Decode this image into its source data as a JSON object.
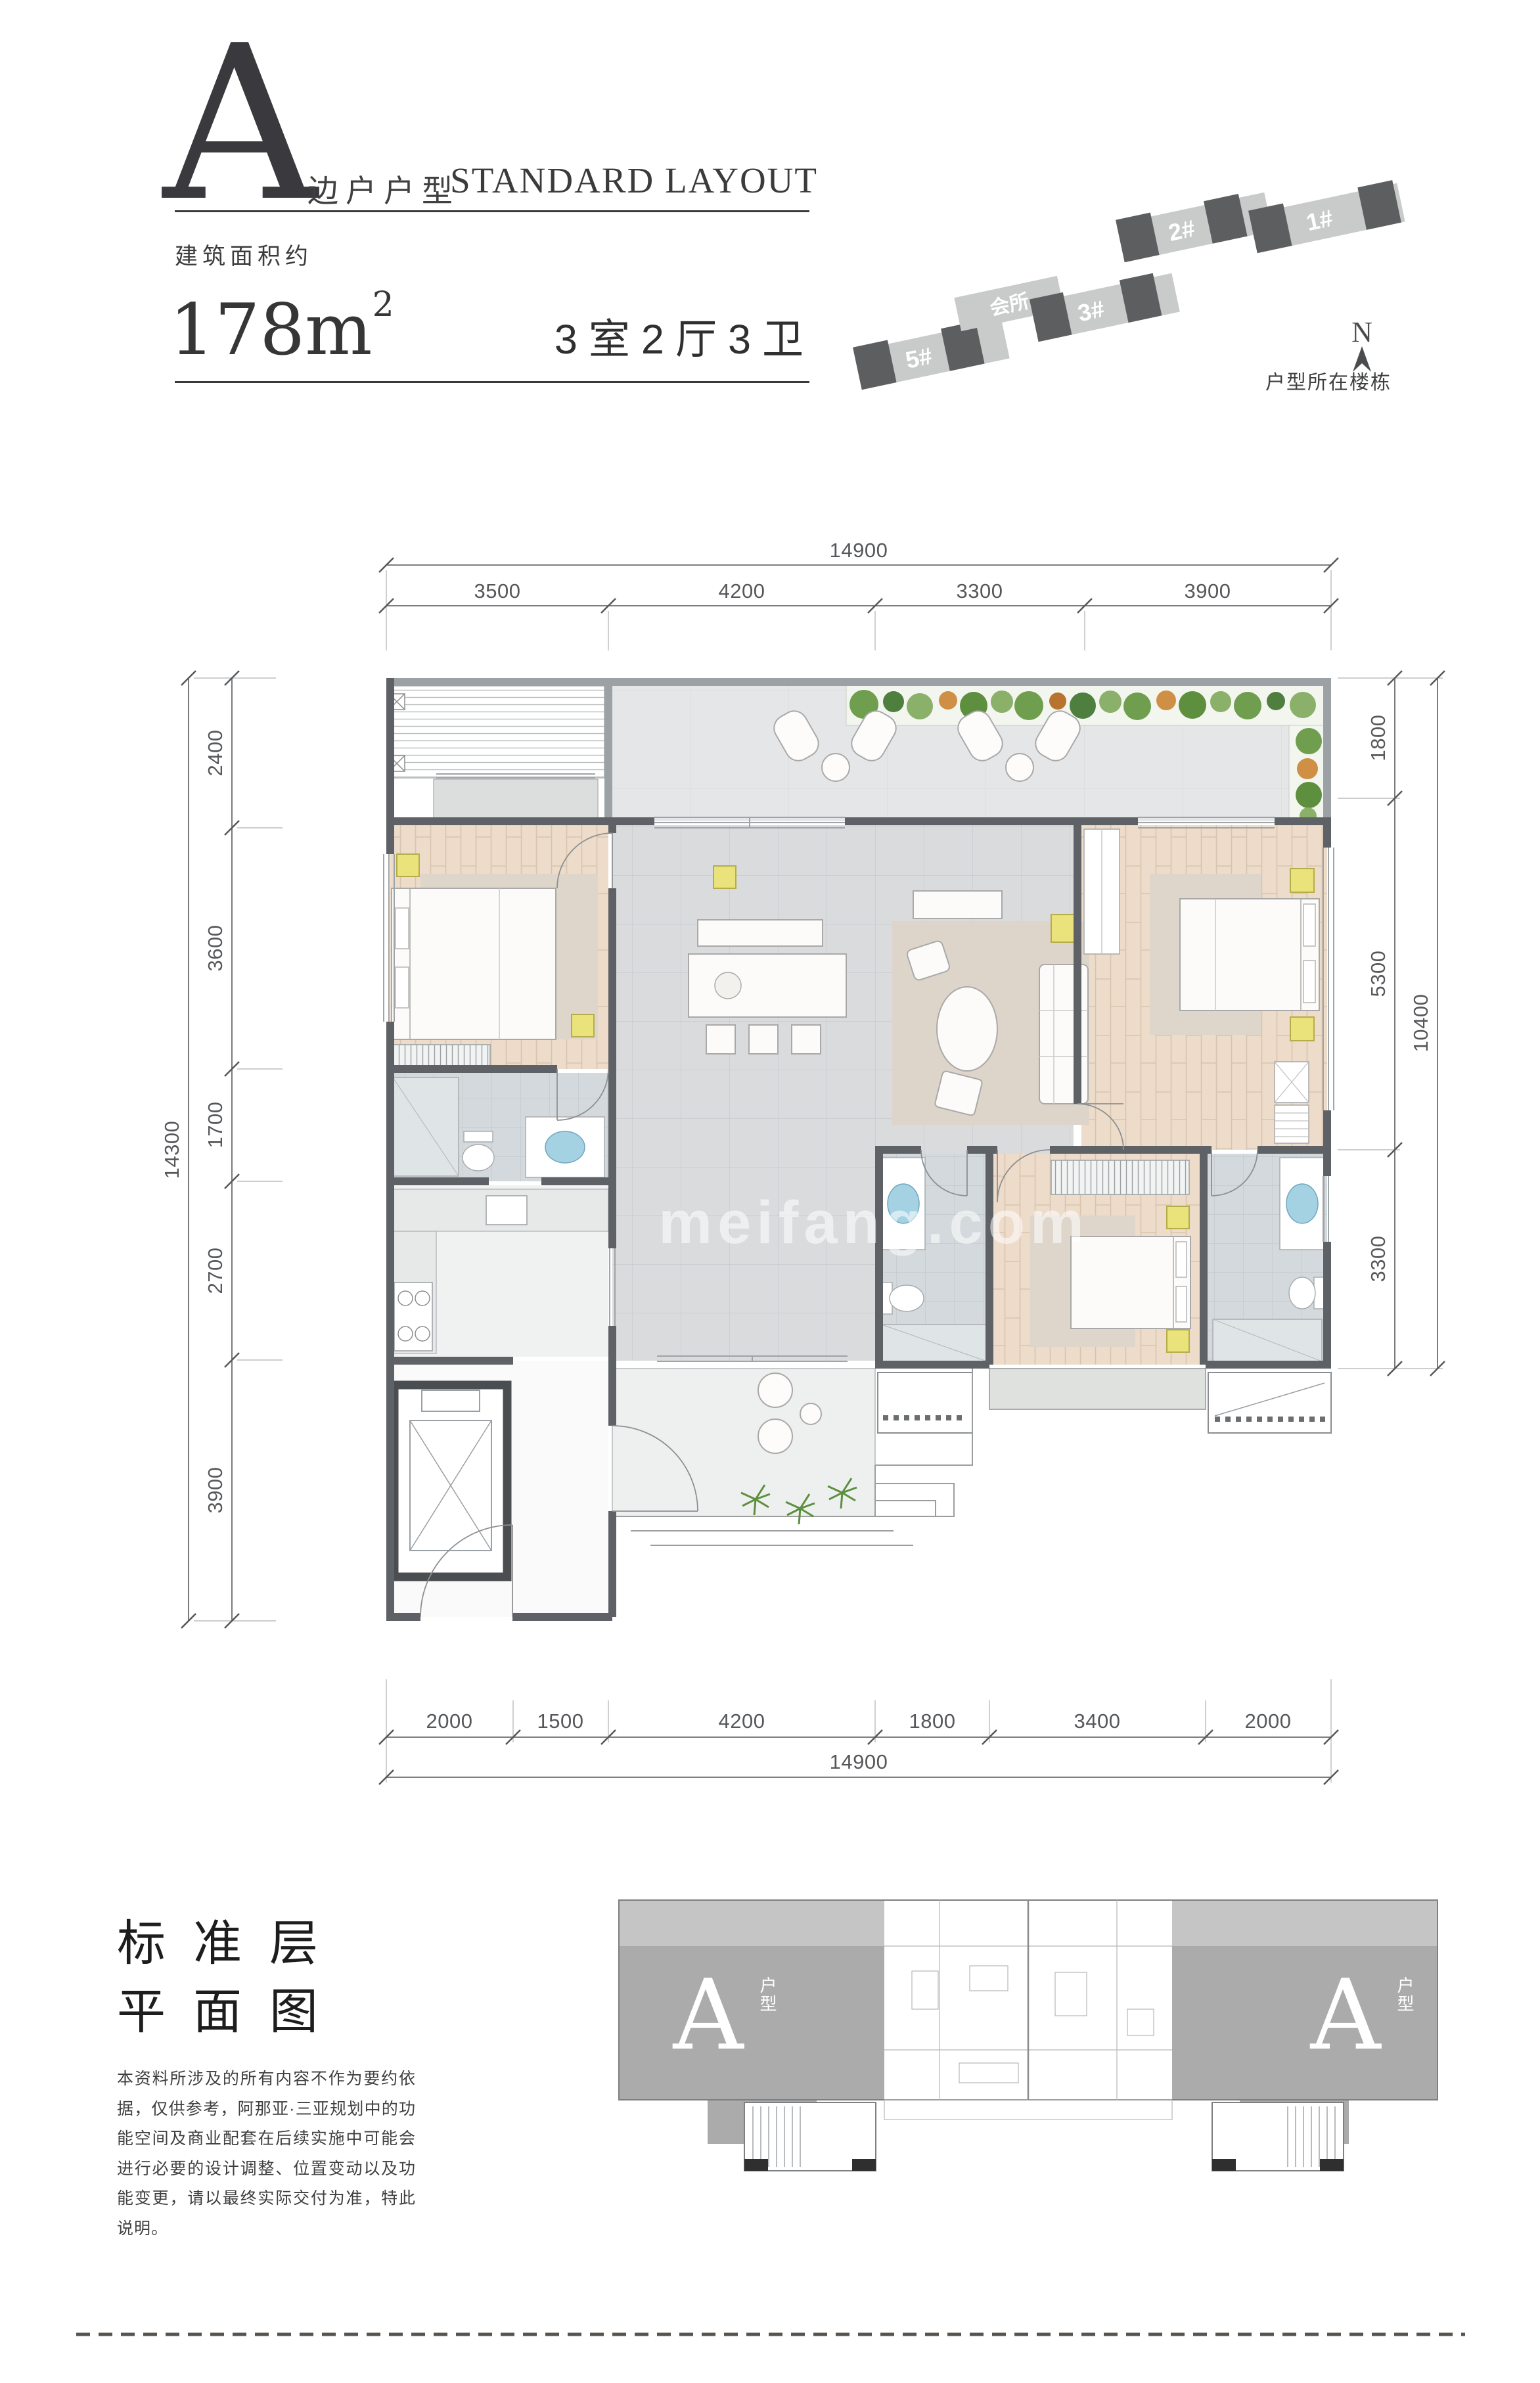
{
  "header": {
    "unit_letter": "A",
    "unit_type_label": "边户户型",
    "layout_label_en": "STANDARD LAYOUT",
    "area_prefix": "建筑面积约",
    "area_value": "178m",
    "area_sup": "2",
    "rooms_label": "3室2厅3卫"
  },
  "site_map": {
    "buildings": [
      {
        "label": "5#"
      },
      {
        "label": "会所"
      },
      {
        "label": "3#"
      },
      {
        "label": "2#"
      },
      {
        "label": "1#"
      }
    ],
    "north_label": "N",
    "caption": "户型所在楼栋"
  },
  "floor_plan": {
    "watermark": "meifang.com",
    "dims": {
      "top": {
        "total": "14900",
        "segments": [
          "3500",
          "4200",
          "3300",
          "3900"
        ]
      },
      "left": {
        "total": "14300",
        "segments": [
          "2400",
          "3600",
          "1700",
          "2700",
          "3900"
        ]
      },
      "right": {
        "total": "10400",
        "segments": [
          "1800",
          "5300",
          "3300"
        ]
      },
      "bottom": {
        "total": "14900",
        "segments": [
          "2000",
          "1500",
          "4200",
          "1800",
          "3400",
          "2000"
        ]
      }
    }
  },
  "footer": {
    "title_line1": "标准层",
    "title_line2": "平面图",
    "disclaimer": "本资料所涉及的所有内容不作为要约依据，仅供参考，阿那亚·三亚规划中的功能空间及商业配套在后续实施中可能会进行必要的设计调整、位置变动以及功能变更，请以最终实际交付为准，特此说明。",
    "key_plan": {
      "unit_label": "A",
      "unit_sub_label": "户型"
    }
  }
}
